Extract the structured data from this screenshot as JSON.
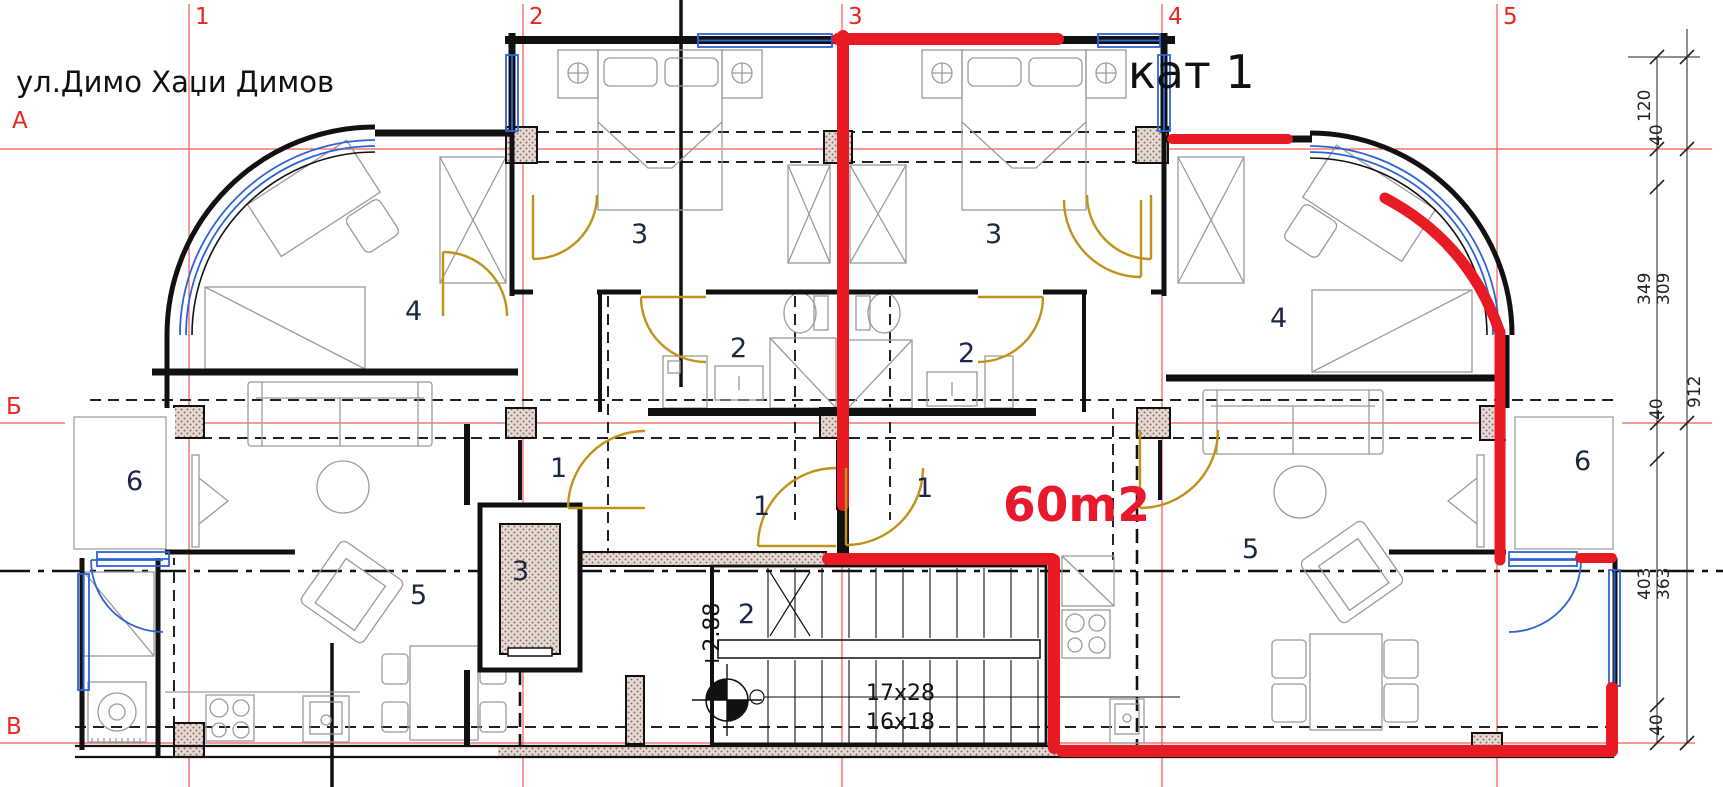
{
  "title": {
    "street": "ул.Димо Хаџи Димов",
    "floor": "кат 1"
  },
  "annotations": {
    "area_label": "60m2",
    "level_mark": "+2.88",
    "stair_dim_top": "17x28",
    "stair_dim_bottom": "16x18"
  },
  "grid": {
    "columns": [
      "1",
      "2",
      "3",
      "4",
      "5"
    ],
    "rows": [
      "А",
      "Б",
      "В"
    ]
  },
  "dimensions": {
    "right": {
      "d120": "120",
      "d40a": "40",
      "d349": "349",
      "d309": "309",
      "d912": "912",
      "d40b": "40",
      "d403": "403",
      "d363": "363",
      "d40c": "40"
    },
    "bottom": {
      "left": "4.00",
      "center": "840"
    }
  },
  "rooms": {
    "west": {
      "bedroom": "3",
      "bath": "2",
      "wing": "4",
      "hall": "1",
      "entry": "1",
      "living": "5",
      "balcony": "6"
    },
    "east": {
      "bedroom": "3",
      "bath": "2",
      "wing": "4",
      "hall": "1",
      "living": "5",
      "balcony": "6"
    },
    "core": {
      "stair_hall": "2",
      "elevator": "3"
    }
  },
  "colors": {
    "wall_red": "#e81a23",
    "window_blue": "#2e63d8",
    "door_gold": "#c0921a",
    "grid_red": "#ee2c24",
    "wall_black": "#111111",
    "furniture_gray": "#9b9b9b"
  }
}
